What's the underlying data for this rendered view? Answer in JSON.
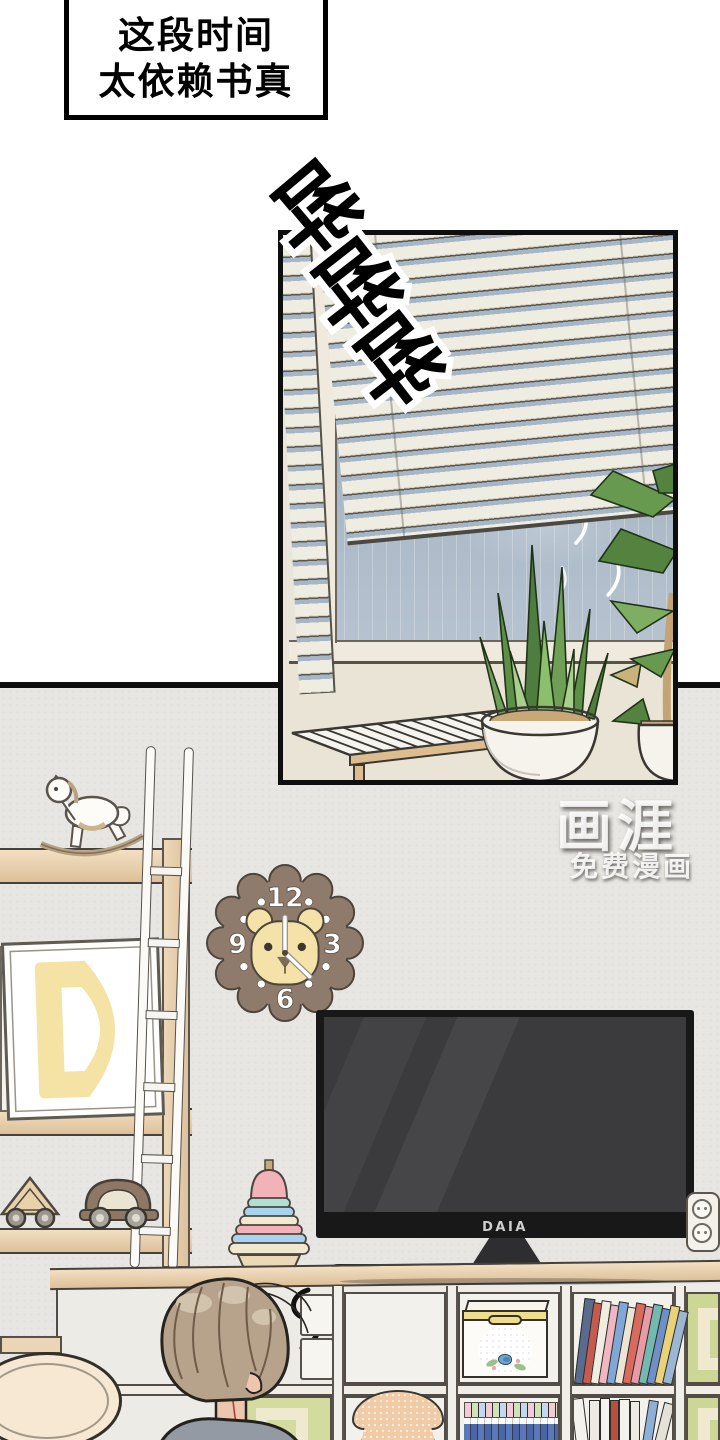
{
  "page": {
    "type": "comic-page",
    "language": "zh-CN"
  },
  "dialogue_box": {
    "line1": "这段时间",
    "line2": "太依赖书真"
  },
  "sfx": {
    "meaning": "rain-sound",
    "chars": [
      "哗",
      "哗",
      "哗"
    ]
  },
  "watermark": {
    "brand": "画涯",
    "tagline": "免费漫画"
  },
  "scene": {
    "tv_brand": "DAIA",
    "clock_numbers": {
      "top": "12",
      "right": "3",
      "bottom": "6",
      "left": "9"
    },
    "objects": [
      "venetian-blinds",
      "rainy-window",
      "slatted-bench",
      "snake-plant",
      "potted-tree",
      "rocking-horse",
      "white-ladder",
      "letter-d-frame",
      "toy-cars",
      "stacking-rings",
      "lion-clock",
      "television",
      "cube-bookshelf",
      "storage-box",
      "books",
      "dotted-stool",
      "power-outlet",
      "round-table",
      "person-back-view"
    ]
  },
  "colors": {
    "panel_border": "#0e0e0e",
    "wall": "#e8e6e2",
    "window_sky": "#a9b8c6",
    "blind_slat": "#efece2",
    "wood": "#e9d2b0",
    "clock_wood": "#8e7b6b",
    "lion_face": "#f5e2a9",
    "tv_screen": "#3b3b3d",
    "hair": "#b7a38c",
    "shirt": "#949aa3",
    "accent_green_cell": "#ccd795"
  }
}
